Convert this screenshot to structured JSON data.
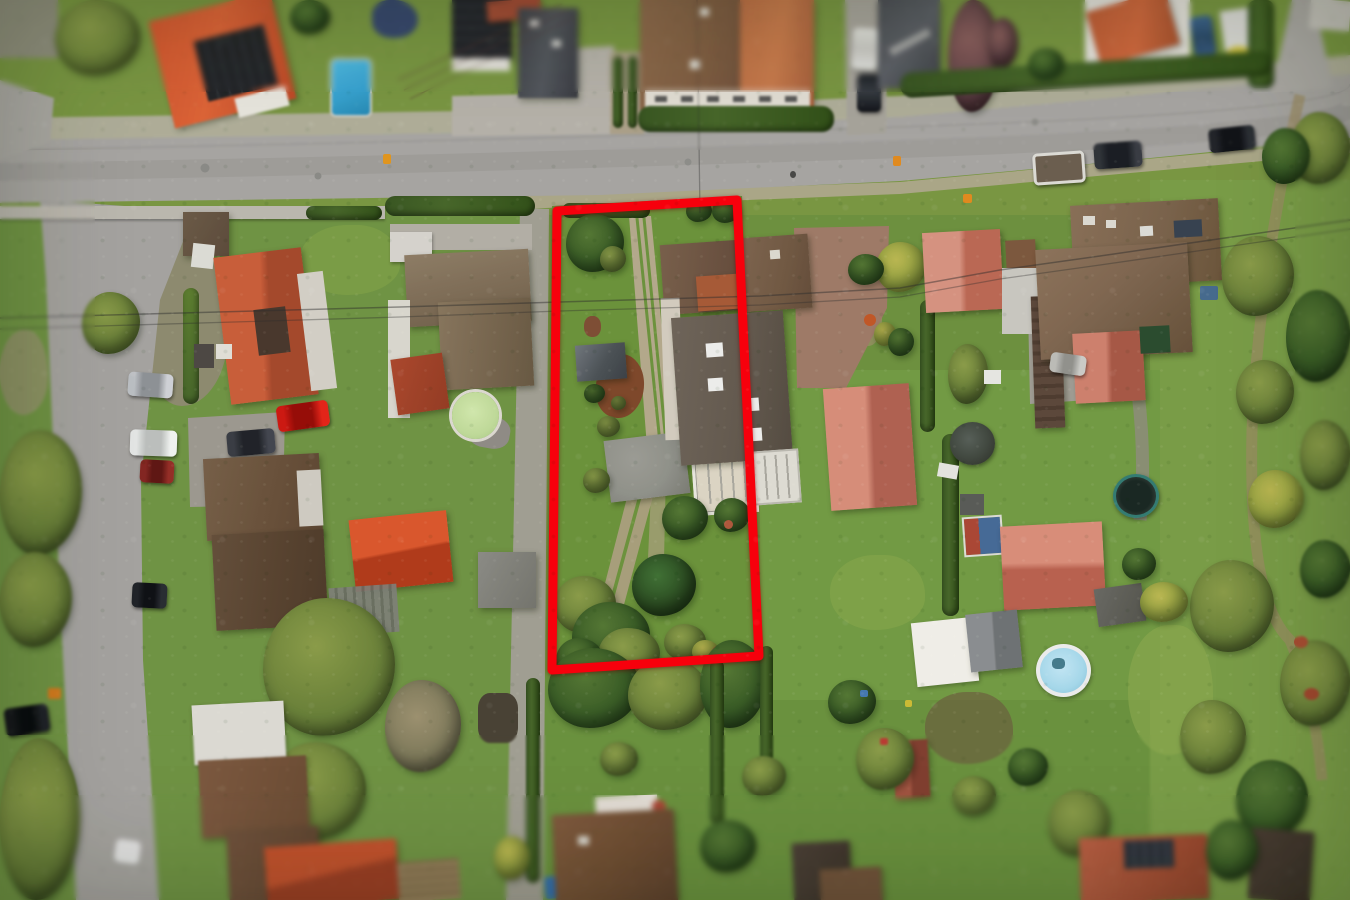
{
  "scene": {
    "type": "aerial-drone-photograph",
    "description": "Top-down aerial view of a suburban residential neighborhood in autumn; a narrow rectangular property plot with garden, sheds and part of a house is highlighted by a thick red boundary outline; a main road crosses the upper part of the image and a side road runs down the left edge; surrounding lots contain houses with orange, brown, salmon and dark roofs, lawns, hedges, trees, parked cars, swimming pools and a trampoline."
  },
  "boundary": {
    "points": "557,211 737,200 759,656 552,670",
    "color": "#e60812",
    "stroke_width": 9
  },
  "palette": {
    "annotation_red": "#e60812",
    "grass": "#6f8f46",
    "grass_light": "#8aa455",
    "road": "#a5a3a0",
    "gravel": "#b2aea2",
    "roof_orange": "#b05a3d",
    "roof_orange_bright": "#bf4e2d",
    "roof_brown": "#77604d",
    "roof_dark_gray": "#4e5055",
    "roof_salmon": "#c07868",
    "solar_panel": "#26282c",
    "hedge_green": "#3e5529",
    "pool_blue": "#3e9ec6",
    "round_pool_blue": "#a7d4e4",
    "garden_pool_green": "#bed69c",
    "trampoline_teal": "#3a7a72"
  }
}
